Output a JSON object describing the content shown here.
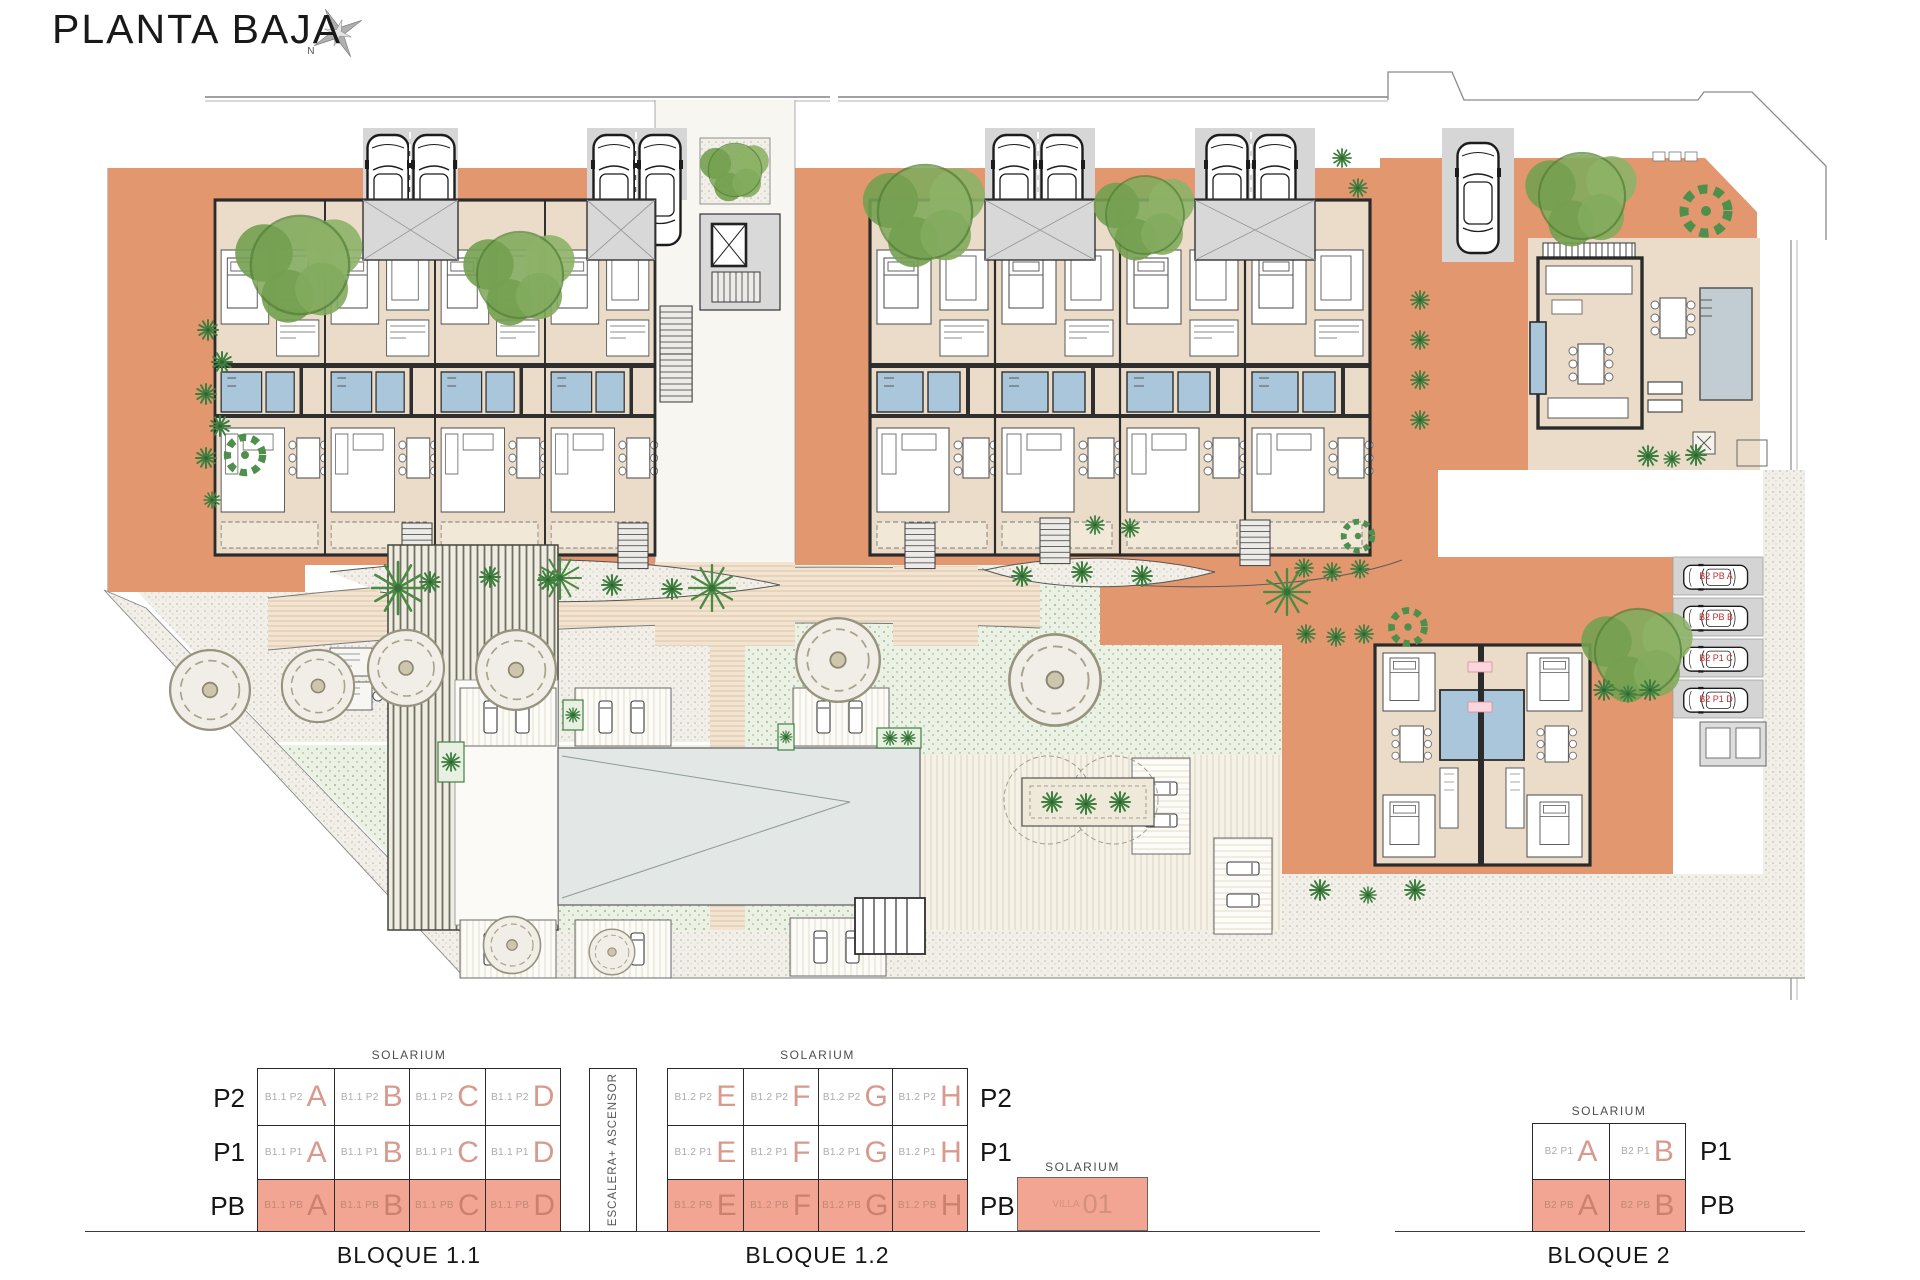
{
  "header": {
    "title": "PLANTA BAJA",
    "compass_n": "N"
  },
  "plan": {
    "parking_labels": [
      "B2 PB A",
      "B2 PB B",
      "B2 P1 C",
      "B2 P1 D"
    ]
  },
  "legend": {
    "solarium": "SOLARIUM",
    "escalera": "ESCALERA+ ASCENSOR",
    "bloque11": {
      "label": "BLOQUE 1.1",
      "floors": [
        "P2",
        "P1",
        "PB"
      ],
      "rows": [
        {
          "cells": [
            {
              "prefix": "B1.1 P2",
              "letter": "A"
            },
            {
              "prefix": "B1.1 P2",
              "letter": "B"
            },
            {
              "prefix": "B1.1 P2",
              "letter": "C"
            },
            {
              "prefix": "B1.1 P2",
              "letter": "D"
            }
          ]
        },
        {
          "cells": [
            {
              "prefix": "B1.1 P1",
              "letter": "A"
            },
            {
              "prefix": "B1.1 P1",
              "letter": "B"
            },
            {
              "prefix": "B1.1 P1",
              "letter": "C"
            },
            {
              "prefix": "B1.1 P1",
              "letter": "D"
            }
          ]
        },
        {
          "cells": [
            {
              "prefix": "B1.1 PB",
              "letter": "A"
            },
            {
              "prefix": "B1.1 PB",
              "letter": "B"
            },
            {
              "prefix": "B1.1 PB",
              "letter": "C"
            },
            {
              "prefix": "B1.1 PB",
              "letter": "D"
            }
          ]
        }
      ]
    },
    "bloque12": {
      "label": "BLOQUE 1.2",
      "floors": [
        "P2",
        "P1",
        "PB"
      ],
      "rows": [
        {
          "cells": [
            {
              "prefix": "B1.2 P2",
              "letter": "E"
            },
            {
              "prefix": "B1.2 P2",
              "letter": "F"
            },
            {
              "prefix": "B1.2 P2",
              "letter": "G"
            },
            {
              "prefix": "B1.2 P2",
              "letter": "H"
            }
          ]
        },
        {
          "cells": [
            {
              "prefix": "B1.2 P1",
              "letter": "E"
            },
            {
              "prefix": "B1.2 P1",
              "letter": "F"
            },
            {
              "prefix": "B1.2 P1",
              "letter": "G"
            },
            {
              "prefix": "B1.2 P1",
              "letter": "H"
            }
          ]
        },
        {
          "cells": [
            {
              "prefix": "B1.2 PB",
              "letter": "E"
            },
            {
              "prefix": "B1.2 PB",
              "letter": "F"
            },
            {
              "prefix": "B1.2 PB",
              "letter": "G"
            },
            {
              "prefix": "B1.2 PB",
              "letter": "H"
            }
          ]
        }
      ]
    },
    "villa": {
      "prefix": "VILLA",
      "number": "01"
    },
    "bloque2": {
      "label": "BLOQUE 2",
      "floors": [
        "P1",
        "PB"
      ],
      "rows": [
        {
          "cells": [
            {
              "prefix": "B2 P1",
              "letter": "A"
            },
            {
              "prefix": "B2 P1",
              "letter": "B"
            }
          ]
        },
        {
          "cells": [
            {
              "prefix": "B2 PB",
              "letter": "A"
            },
            {
              "prefix": "B2 PB",
              "letter": "B"
            }
          ]
        }
      ]
    }
  },
  "colors": {
    "terrace": "#E2976F",
    "highlight": "#F2A593",
    "bath": "#A9C6DA",
    "lawn": "#ECF1E6"
  }
}
